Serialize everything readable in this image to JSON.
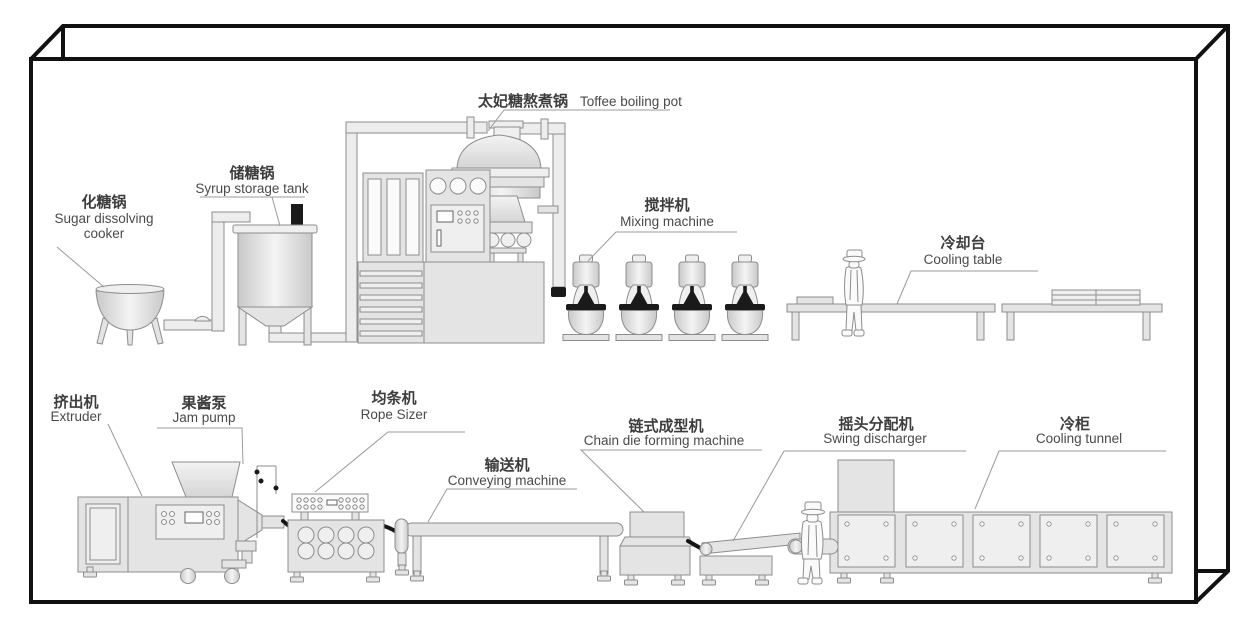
{
  "labels": {
    "sugar_cooker": {
      "zh": "化糖锅",
      "en1": "Sugar dissolving",
      "en2": "cooker"
    },
    "syrup_tank": {
      "zh": "储糖锅",
      "en": "Syrup storage tank"
    },
    "toffee_pot": {
      "zh": "太妃糖熬煮锅",
      "en": "Toffee boiling pot"
    },
    "mixer": {
      "zh": "搅拌机",
      "en": "Mixing machine"
    },
    "cooling_table": {
      "zh": "冷却台",
      "en": "Cooling table"
    },
    "extruder": {
      "zh": "挤出机",
      "en": "Extruder"
    },
    "jam_pump": {
      "zh": "果酱泵",
      "en": "Jam pump"
    },
    "rope_sizer": {
      "zh": "均条机",
      "en": "Rope Sizer"
    },
    "conveyor": {
      "zh": "输送机",
      "en": "Conveying machine"
    },
    "chain_die": {
      "zh": "链式成型机",
      "en": "Chain die forming machine"
    },
    "swing_discharger": {
      "zh": "摇头分配机",
      "en": "Swing discharger"
    },
    "cooling_tunnel": {
      "zh": "冷柜",
      "en": "Cooling tunnel"
    }
  },
  "flow_order": {
    "top_row": [
      "sugar_cooker",
      "syrup_tank",
      "toffee_pot",
      "mixer",
      "cooling_table"
    ],
    "bottom_row": [
      "extruder",
      "jam_pump",
      "rope_sizer",
      "conveyor",
      "chain_die",
      "swing_discharger",
      "cooling_tunnel"
    ]
  },
  "colors": {
    "background": "#ffffff",
    "machine_fill": "#e4e4e4",
    "outline": "#8d8d8d",
    "dark_accent": "#1a1a1a",
    "label_text": "#4a4a4a",
    "frame": "#111111"
  }
}
